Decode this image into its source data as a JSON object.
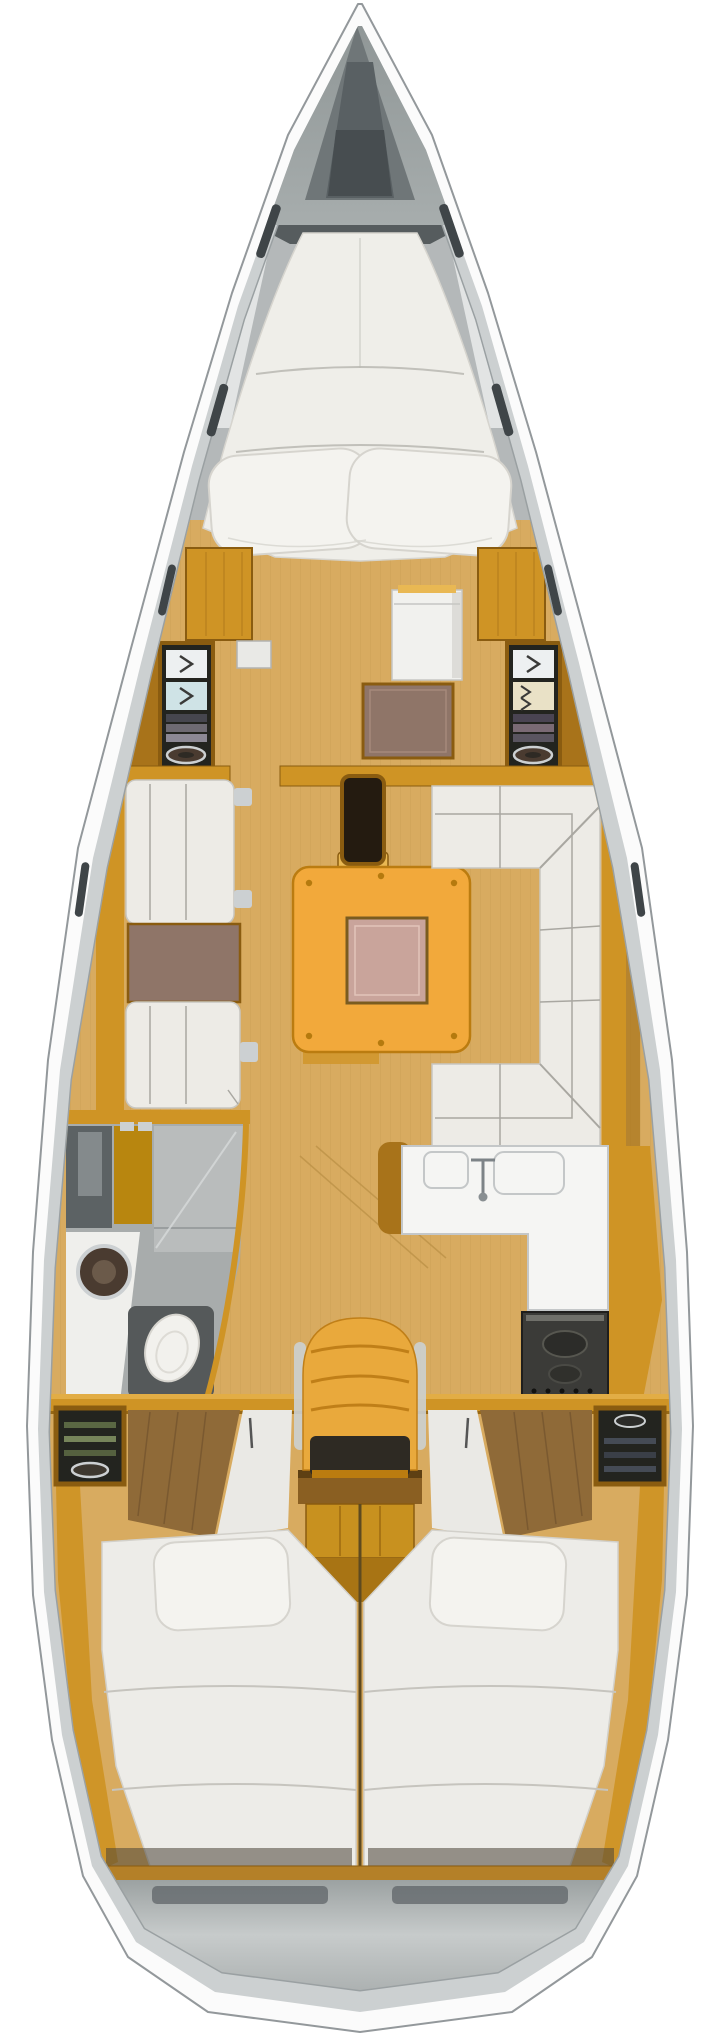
{
  "document": {
    "type": "sailboat-interior-floor-plan",
    "view": "top-down",
    "orientation": "bow-up"
  },
  "areas": [
    "bow-deck-with-anchor-locker",
    "forward-v-berth-cabin",
    "forward-wardrobes-and-shelf-lockers",
    "saloon-port-settee-with-side-table",
    "saloon-central-folding-table",
    "saloon-starboard-u-settee",
    "mast-post",
    "head-with-shower-sink-toilet",
    "galley-with-sink-counter-and-stove",
    "nav-seat-and-chart-desk",
    "companionway-steps",
    "port-aft-double-cabin",
    "starboard-aft-double-cabin",
    "stern-transom-locker"
  ],
  "palette": {
    "bg": "#ffffff",
    "hullRim": "#fbfbfb",
    "hullStroke": "#93989b",
    "band": "#ccd0d1",
    "wallShadow": "#9aa0a2",
    "deck": "#9aa1a1",
    "deckDark": "#6f7678",
    "anchorHatch": "#596063",
    "anchorHatchInner": "#474d50",
    "bowShadow": "#565c5e",
    "liner": "#e7e9e9",
    "mattress": "#efeee9",
    "mattressSeam": "#b9b7b1",
    "pillow": "#f4f3ef",
    "pillowEdge": "#d6d4ce",
    "woodMain": "#cf9425",
    "woodLight": "#e9b853",
    "woodDark": "#a8731a",
    "woodFrame": "#8a5c10",
    "floorTan": "#d8ab60",
    "floorLine": "#b98e44",
    "panelBrown": "#8f7568",
    "tableYellow": "#f2a93b",
    "tableEdge": "#bb7c10",
    "tableInset": "#c9a49b",
    "insetBorder": "#7a5c20",
    "settee": "#edebe6",
    "setteeSeam": "#a9a7a1",
    "headFloor": "#a8acac",
    "showerDark": "#5c6264",
    "showerLight": "#848a8c",
    "showerFloor": "#b9bcbc",
    "glass": "#d7dadb",
    "sinkDark": "#4a3b30",
    "metal": "#ccd0d2",
    "toiletWhite": "#f2f1ed",
    "toiletTray": "#55595a",
    "counterWhite": "#f5f5f3",
    "counterEdge": "#c4c7c8",
    "stoveDark": "#3b3b38",
    "stoveRing": "#575750",
    "chairYellow": "#e9a93c",
    "chairRib": "#c07f18",
    "chairSeatDark": "#2e2a23",
    "deskWood": "#8a5f22",
    "deskTop": "#5e4013",
    "stepsWood": "#c8911f",
    "stepsPoint": "#a87414",
    "lockerDark": "#23241f",
    "shelfGreen": "#5a6743",
    "shelfGreenLight": "#76845a",
    "shelfGray": "#454b55",
    "clothDark": "#46464e",
    "clothMid": "#6e6a72",
    "clothLight": "#8c8894",
    "chevronBg": "#edf0f1",
    "chevronBg2": "#cfe3e6",
    "chevronBg3": "#e9e1c6",
    "chevronMark": "#3a3a38",
    "drawerWhite": "#e9e9e6",
    "fridgeWhite": "#f1f1ee",
    "berthWhite": "#edece8",
    "berthSeam": "#c6c4be",
    "aftPanelWood": "#8f6a38",
    "aftPanelLine": "#7a5930",
    "wedgeWhite": "#eae9e5",
    "shelfFoot": "#b48028",
    "sternSlot": "#5a6064",
    "windowSlit": "#3f4548",
    "divider": "#5e4a20",
    "shadowDark": "#4a4336"
  }
}
